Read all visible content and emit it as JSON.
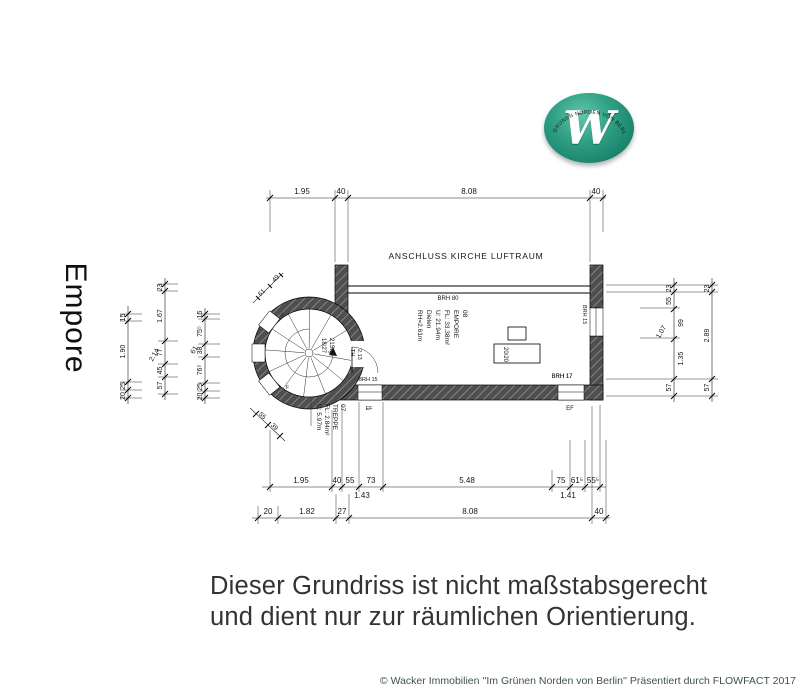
{
  "title": {
    "vertical_label": "Empore"
  },
  "logo": {
    "letter": "W",
    "arc_text": "IM GRÜNEN NORDEN VON BERLIN",
    "ball_color": "#2a9c80"
  },
  "plan": {
    "header": "ANSCHLUSS KIRCHE LUFTRAUM",
    "room_label": [
      "08",
      "EMPORE",
      "FL: 33.38m²",
      "U: 21.94m",
      "Dielen",
      "RH=2.61m"
    ],
    "stair_room_label": [
      "07",
      "TREPPE",
      "FL: 2.84m²",
      "U: 5.97m"
    ],
    "stair_note": [
      "21Stg",
      "18/27"
    ],
    "door_note": [
      "2.13",
      "TH"
    ],
    "pillar_label": "20/20",
    "labels": {
      "brh80": "BRH 80",
      "brh17": "BRH 17",
      "brh15_window": "BRH 15",
      "brh15_right": "BRH 15",
      "ef_right": "EF",
      "ef_left": "EF",
      "f1": "F",
      "f2": "F"
    }
  },
  "dims": {
    "top": [
      "1.95",
      "40",
      "8.08",
      "40"
    ],
    "bottom_row1": [
      "1.95",
      "40",
      "55",
      "73",
      "5.48",
      "75",
      "61⁵",
      "55⁵"
    ],
    "bottom_row1_sub": [
      "1.43",
      "1.41"
    ],
    "bottom_row2": [
      "20",
      "1.82",
      "27",
      "8.08",
      "40"
    ],
    "left_chain1": [
      "15",
      "1.90",
      "25",
      "20"
    ],
    "left_chain2": [
      "23",
      "1.67",
      "77",
      "45",
      "57"
    ],
    "left_chain2_diag": "2.14",
    "left_chain3": [
      "15",
      "75⁵",
      "38",
      "76⁵",
      "25",
      "20"
    ],
    "left_chain3_diag": "61",
    "right_inner": [
      "23",
      "55",
      "99",
      "1.35",
      "57"
    ],
    "right_inner_diag": "1.07",
    "right_outer": [
      "23",
      "2.89",
      "57"
    ],
    "diag_top_left": [
      "49",
      "61"
    ],
    "diag_bottom_left": [
      "55",
      "39"
    ]
  },
  "disclaimer": {
    "line1": "Dieser Grundriss ist nicht maßstabsgerecht",
    "line2": "und dient nur zur räumlichen Orientierung."
  },
  "footer": "© Wacker Immobilien ''Im Grünen Norden von Berlin'' Präsentiert durch FLOWFACT 2017"
}
